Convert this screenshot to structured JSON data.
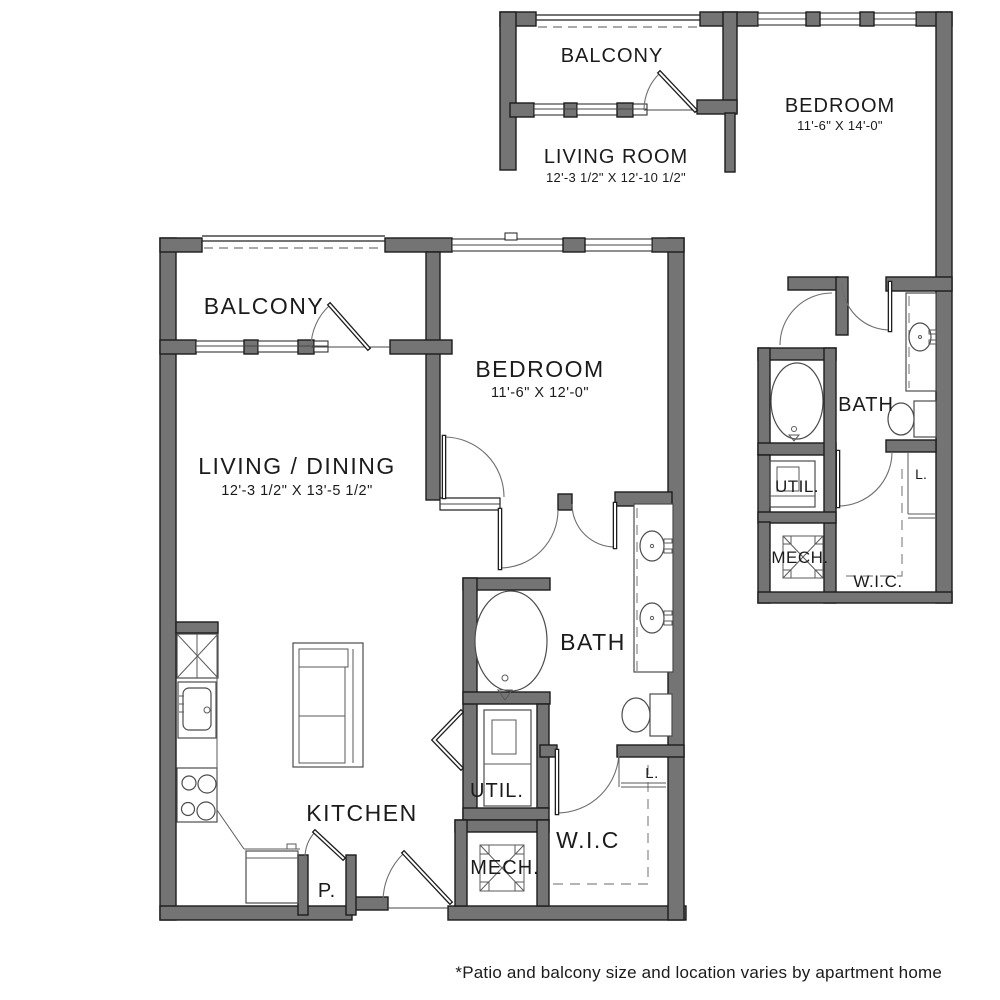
{
  "colors": {
    "background": "#ffffff",
    "wall_fill": "#747474",
    "wall_outline": "#1c1c1c",
    "text": "#1b1b1b"
  },
  "footnote": {
    "text": "*Patio and balcony size and location varies by apartment home"
  },
  "plan_a": {
    "balcony": {
      "label": "BALCONY"
    },
    "living": {
      "label": "LIVING / DINING",
      "dims": "12'-3 1/2\" X 13'-5 1/2\""
    },
    "bedroom": {
      "label": "BEDROOM",
      "dims": "11'-6\" X 12'-0\""
    },
    "bath": {
      "label": "BATH"
    },
    "kitchen": {
      "label": "KITCHEN"
    },
    "util": {
      "label": "UTIL."
    },
    "mech": {
      "label": "MECH."
    },
    "wic": {
      "label": "W.I.C"
    },
    "pantry": {
      "label": "P."
    },
    "linen": {
      "label": "L."
    }
  },
  "plan_b": {
    "balcony": {
      "label": "BALCONY"
    },
    "living": {
      "label": "LIVING ROOM",
      "dims": "12'-3 1/2\" X 12'-10 1/2\""
    },
    "bedroom": {
      "label": "BEDROOM",
      "dims": "11'-6\" X 14'-0\""
    },
    "bath": {
      "label": "BATH"
    },
    "util": {
      "label": "UTIL."
    },
    "mech": {
      "label": "MECH."
    },
    "wic": {
      "label": "W.I.C."
    },
    "linen": {
      "label": "L."
    }
  }
}
